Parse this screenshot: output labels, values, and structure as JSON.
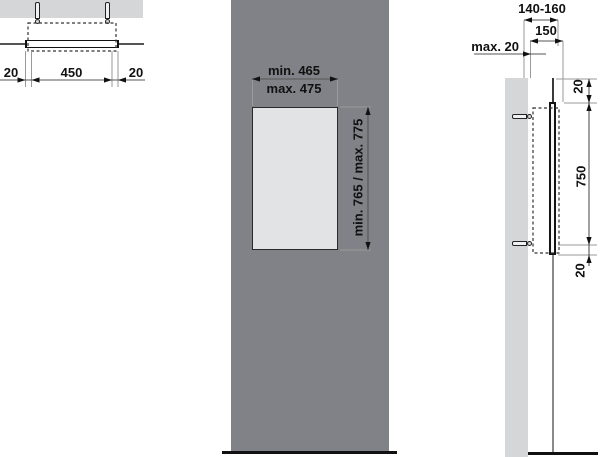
{
  "colors": {
    "panel": "#818287",
    "wall": "#d5d6d8",
    "mirror": "#e2e3e4",
    "line": "#1a1a1a"
  },
  "top_view": {
    "offset_left": "20",
    "width": "450",
    "offset_right": "20"
  },
  "front_view": {
    "width_min": "min. 465",
    "width_max": "max. 475",
    "height_range": "min. 765 / max. 775"
  },
  "side_view": {
    "depth_range": "140-160",
    "depth_nominal": "150",
    "wall_clearance": "max. 20",
    "gap_top": "20",
    "height": "750",
    "gap_bottom": "20"
  }
}
